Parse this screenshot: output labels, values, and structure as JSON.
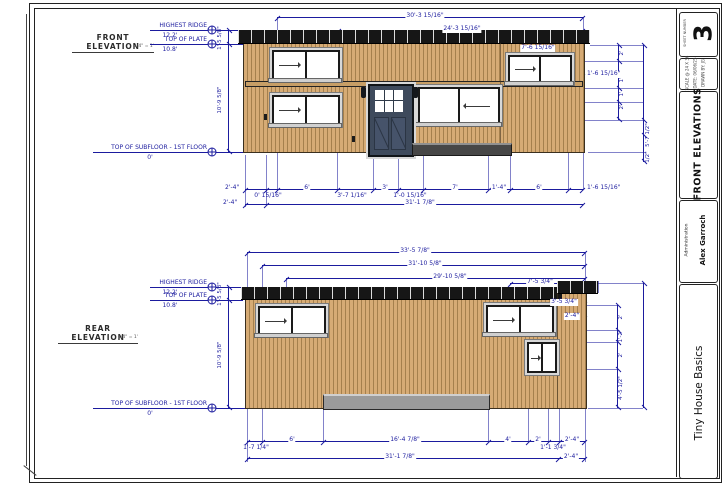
{
  "levels": {
    "ridge_name": "HIGHEST RIDGE",
    "ridge_elev": "12.2'",
    "plate_name": "TOP OF PLATE",
    "plate_elev": "10.8'",
    "floor_name": "TOP OF SUBFLOOR - 1ST FLOOR",
    "floor_elev": "0'"
  },
  "shared_vertical_dims": {
    "plate_to_ridge": "1'-5 5/8\"",
    "floor_to_plate": "10'-9 5/8\""
  },
  "front": {
    "title": "FRONT ELEVATION",
    "scale_note": "1/4\" = 1'",
    "dim_overall_top": "30'-3 15/16\"",
    "dim_main_roof": "24'-3 15/16\"",
    "dim_right_window": "7'-6 15/16\"",
    "dim_right_offset": "1'-6 15/16\"",
    "dims_bottom_row1": [
      "2'-4\"",
      "0' 15/16\"",
      "6'",
      "3'-7 1/16\"",
      "3'",
      "1'-0 15/16\"",
      "7'",
      "1'-4\"",
      "6'",
      "1'-6 15/16\""
    ],
    "dims_bottom_row2": [
      "2'-4\"",
      "31'-1 7/8\""
    ],
    "dims_right_vertical": [
      "2'",
      "1'",
      "1'",
      "2'",
      "5'-7 1/2\"",
      "1/2\""
    ]
  },
  "rear": {
    "title": "REAR ELEVATION",
    "scale_note": "1/4\" = 1'",
    "dims_top": [
      "33'-5 7/8\"",
      "31'-10 5/8\"",
      "29'-10 5/8\"",
      "7'-5 3/4\"",
      "3'-5 3/4\"",
      "2'-4\""
    ],
    "dims_bottom_row1": [
      "1'-7 1/4\"",
      "6'",
      "16'-4 7/8\"",
      "4'",
      "2'",
      "1'-1 3/4\"",
      "2'-4\""
    ],
    "dims_bottom_row2": [
      "31'-1 7/8\"",
      "2'-4\""
    ],
    "dims_right_vertical": [
      "2'",
      "1'-2\"",
      "2'",
      "4'-5 1/2\""
    ]
  },
  "titleblock": {
    "sheet_number_label": "SHEET NUMBER",
    "sheet_number": "3",
    "info_lines": [
      "SCALE @ 24 X 36",
      "DATE: 06/06/25",
      "DRAWN BY: JG"
    ],
    "sheet_title": "FRONT ELEVATIONS",
    "client_role": "Administration",
    "client_name": "Alex Garroch",
    "company_name": "Tiny House Basics"
  },
  "colors": {
    "dimension": "#1b1b9e",
    "siding": "#d4a873",
    "roof": "#141414",
    "logo_circle": "#1d4f8f"
  }
}
